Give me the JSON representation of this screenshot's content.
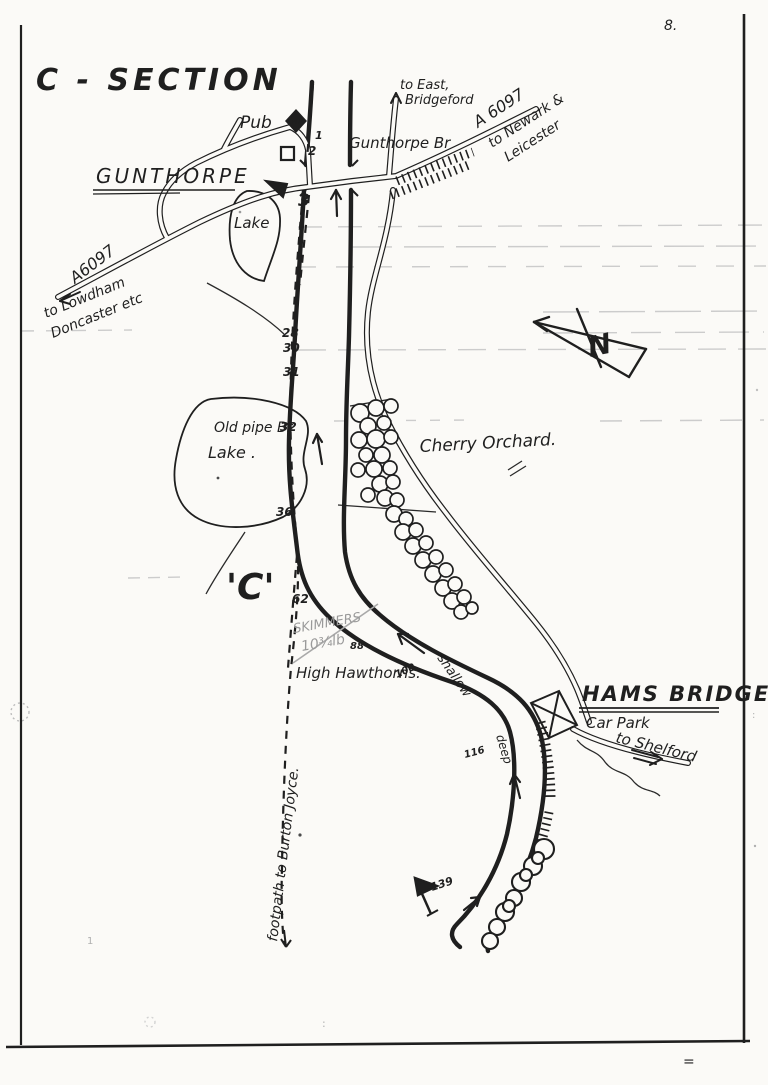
{
  "page": {
    "number": "8.",
    "title": "C - SECTION"
  },
  "compass": {
    "north": "N"
  },
  "village": {
    "name": "GUNTHORPE",
    "pub": "Pub",
    "bridge": "Gunthorpe Br"
  },
  "roads": {
    "a6097_ne": "A 6097",
    "to_newark": "to Newark &",
    "leicester": "Leicester",
    "a6097_sw": "A6097",
    "to_lowdham": "to Lowdham",
    "doncaster_etc": "Doncaster etc",
    "to_east_1": "to East,",
    "to_east_2": "Bridgeford",
    "car_park": "Car Park",
    "to_shelford": "to Shelford"
  },
  "footpath": {
    "label": "footpath to Burton Joyce."
  },
  "features": {
    "lake_upper": "Lake",
    "lake_lower": "Lake .",
    "old_pipe_br": "Old pipe Br",
    "cherry_orchard": "Cherry Orchard.",
    "high_hawthorns": "High Hawthorns.",
    "section_marker": "'C'",
    "hams_bridge": "HAMS BRIDGE"
  },
  "river": {
    "shallow": "shallow",
    "deep": "deep"
  },
  "pencil": {
    "line1": "SKIMMERS",
    "line2": "10¾lb"
  },
  "pegs": {
    "n1": "1",
    "n2": "2",
    "n3": "3",
    "n28": "28",
    "n30": "30",
    "n31": "31",
    "n32": "32",
    "n36": "36",
    "n62": "62",
    "n88": "88",
    "n100": "100",
    "n116": "116",
    "n139": "139"
  },
  "marks": {
    "colon": ":",
    "equals": "=",
    "stray_one": "1"
  },
  "colors": {
    "ink": "#1f1f1f",
    "pencil": "#9a9a9a",
    "paper": "#fbfaf7",
    "faint": "#c9c9c9"
  }
}
